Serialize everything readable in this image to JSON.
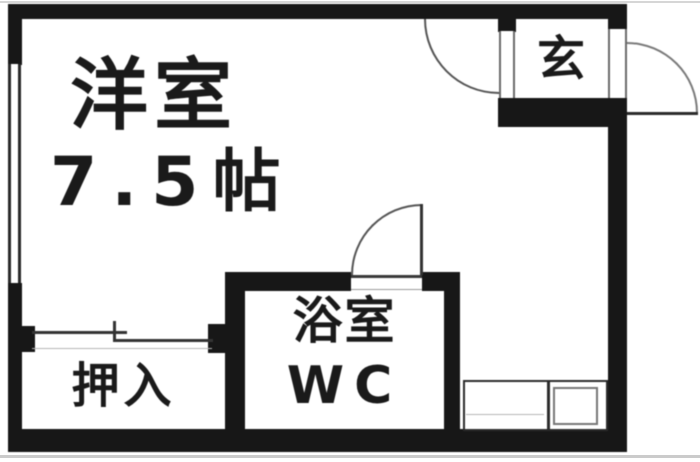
{
  "floorplan": {
    "main_room": {
      "label": "洋室",
      "size": "7.5帖"
    },
    "entrance": {
      "label": "玄"
    },
    "closet": {
      "label": "押入"
    },
    "bathroom": {
      "label": "浴室",
      "label2": "WC"
    },
    "colors": {
      "wall": "#171717",
      "line": "#555555",
      "bg": "#ffffff",
      "text": "#1a1a1a"
    }
  }
}
